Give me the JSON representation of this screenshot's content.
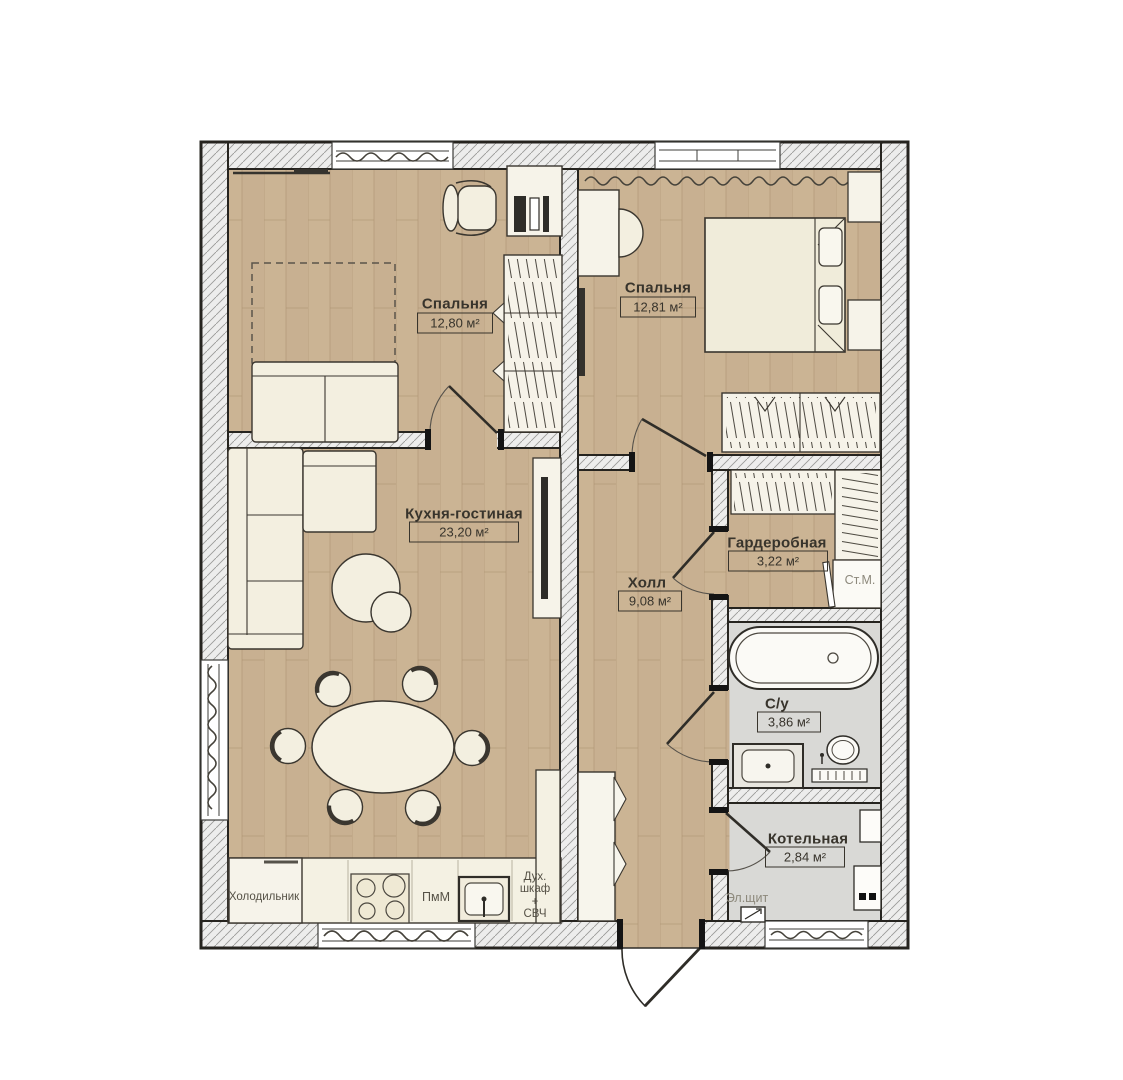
{
  "plan": {
    "rooms": [
      {
        "key": "bedroom-1",
        "name": "Спальня",
        "area": "12,80 м²"
      },
      {
        "key": "bedroom-2",
        "name": "Спальня",
        "area": "12,81 м²"
      },
      {
        "key": "kitchen-living",
        "name": "Кухня-гостиная",
        "area": "23,20 м²"
      },
      {
        "key": "hall",
        "name": "Холл",
        "area": "9,08 м²"
      },
      {
        "key": "wardrobe",
        "name": "Гардеробная",
        "area": "3,22 м²"
      },
      {
        "key": "bathroom",
        "name": "С/у",
        "area": "3,86 м²"
      },
      {
        "key": "boiler",
        "name": "Котельная",
        "area": "2,84 м²"
      }
    ],
    "equipment_labels": {
      "fridge": "Холодильник",
      "dishwasher": "ПмМ",
      "oven_stack": "Дух.\nшкаф\n+\nСВЧ",
      "washing_machine": "Ст.М.",
      "electrical_panel": "Эл.щит"
    },
    "colors": {
      "wood_floor": "#cbb494",
      "tile_floor": "#d9d9d6",
      "wall_fill": "#ededec",
      "furniture_fill": "#f3efe0",
      "line": "#2f2d28"
    }
  }
}
